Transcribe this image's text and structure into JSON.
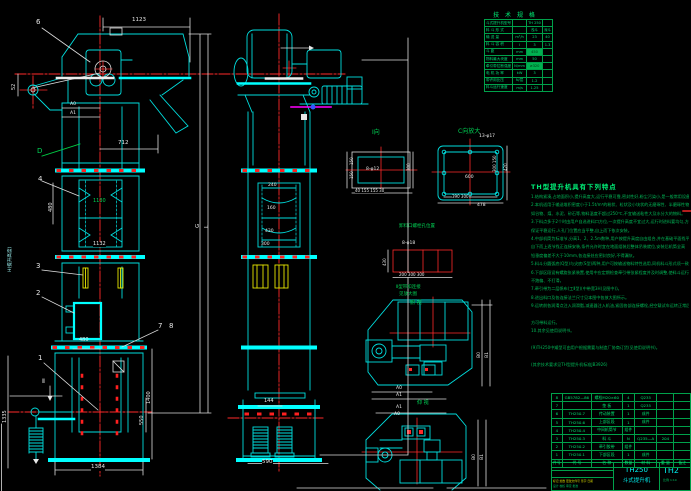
{
  "drawing": {
    "labels": {
      "b6": "6",
      "dim1123": "1123",
      "dim52": "52",
      "a0": "A0",
      "a1": "A1",
      "dlabel": "D",
      "dim712": "712",
      "b4": "4",
      "dim480a": "480",
      "dim1130": "1130",
      "dim1132": "1132",
      "htext": "H(提升高度)",
      "b3": "3",
      "b2": "2",
      "gG": "G",
      "gL": "L",
      "b1": "1",
      "sii": "Ⅱ",
      "dim480b": "480",
      "dim1400": "1400",
      "dim550": "550",
      "dim1335": "1335",
      "dim1384": "1384",
      "b7": "7",
      "b8": "8",
      "s240": "240",
      "s160": "160",
      "s430": "430",
      "s300": "300",
      "dim144": "144",
      "dim590": "590",
      "v1title": "Ⅰ向",
      "v1l1": "150",
      "v1l2": "150",
      "v1r": "300",
      "v1holes": "8-φ12",
      "v1bot": "40 155 155 30",
      "v2title": "C向放大",
      "v2holes": "13-φ17",
      "v2_600": "600",
      "v2r1": "300 150",
      "v2r2": "420",
      "v2bot": "390  300",
      "v2total": "478",
      "rgtitle": "卸料口螺栓孔位置",
      "rgholes": "8-φ18",
      "rg430": "430",
      "rgdims": "200  300  300",
      "bn1": "Ⅱ型带扣连接",
      "bn2": "见放大图",
      "pv1title": "俯 视",
      "pv2title": "仰 视",
      "pv1a0": "A0",
      "pv1a1": "A1",
      "pv1b0": "B0",
      "pv1b1": "B1",
      "pv2a1": "A1",
      "pv2a0": "A0",
      "pv2b0": "B0",
      "pv2b1": "B1"
    },
    "spec_table": {
      "title": "技 术 规 格",
      "rows": [
        [
          "斗式提升机型号",
          "",
          "TH 250",
          ""
        ],
        [
          "料 斗 形 式",
          "",
          "浅斗",
          "深斗"
        ],
        [
          "输 送 量",
          "m³/h",
          "23",
          "40"
        ],
        [
          "料 斗 容 积",
          "l",
          "3",
          "1.3"
        ],
        [
          "斗  距",
          "mm",
          "450",
          ""
        ],
        [
          "物料最大块度",
          "mm",
          "50",
          ""
        ],
        [
          "牵引带拉断强度",
          "N/mm",
          "≥320",
          ""
        ],
        [
          "电 机 功 率",
          "kW",
          "3",
          ""
        ],
        [
          "带许用比压",
          "N/层",
          "1.2",
          ""
        ],
        [
          "料斗运行速度",
          "m/s",
          "1.25",
          ""
        ]
      ]
    },
    "notes": {
      "title": "TH型提升机具有下列特点",
      "lines": [
        "1.结构紧凑,占地面积小,提升高度大,运行平稳可靠,密封性好,粉尘污染小,是一般常用设备。",
        "2.本机适用于输送堆积密度小于1.5t/m³的粉状、粒状及小块状的无磨琢性、半磨琢性物料,",
        "  如谷物、煤、水泥、砂石等,物料温度不超过250℃,不宜输送粘性大及水分大的物料。",
        "3.下料点多于2个时由用户自选进料口方位,一次提升高度不宜过大,运行时进料要均匀,方可",
        "  保证平稳运行,人孔门位置应当平整,自上而下依次安装。",
        "4.中部机筒为标准节,分高1、2、2.5m数种,用户按提升高度自由组合,并在基础平面找平后,",
        "  自下而上逐节找正连接安装,条件允许时宜在地面组装后整体吊装就位,安装后机筒全高",
        "  铅垂度偏差不大于10mm,各连接处应密封良好,不得漏灰。",
        "5.料斗分圆弧底(Q型)与尖底(S型)两种,用户可按输送物料特性选用,同机料斗形式须一致。",
        "6.下部区段设有螺旋张紧装置,使用中应定期检查牵引带张紧程度并及时调整,使料斗运行",
        "  不跑偏、不打滑。",
        "7.牵引带为二层帆布(工Ⅱ型)(中带宽3H(见图中))。",
        "8.进出料口及各连接法兰尺寸见本图中各放大图所示。",
        "9.运转前各润滑点注入润滑脂,减速器注入机油,紧固各部连接螺栓,经空载试车运转正常后",
        "",
        "  方可带料运行。",
        "10.其余见使用说明书。",
        "",
        "(9)TH250中矮型可由用户根据需要与制造厂协商订货(见使用说明书)。",
        "",
        "(其余技术要求见TH型提升机标准JB3926)"
      ]
    },
    "bom": {
      "header": [
        "件号",
        "代 号",
        "名 称",
        "数量",
        "材 料",
        "重 量",
        "备注"
      ],
      "rows": [
        [
          "8",
          "GB5782—86",
          "螺栓M20×60",
          "4",
          "Q235",
          "",
          ""
        ],
        [
          "7",
          "",
          "垫 板",
          "1",
          "Q235",
          "",
          ""
        ],
        [
          "6",
          "TH250.7",
          "传动装置",
          "1",
          "成件",
          "",
          ""
        ],
        [
          "5",
          "TH250.6",
          "上部区段",
          "1",
          "成件",
          "",
          ""
        ],
        [
          "4",
          "TH250.4",
          "中间机筒节",
          "组件",
          "",
          "",
          ""
        ],
        [
          "3",
          "TH250.3",
          "料 斗",
          "N",
          "Q235—A",
          "204",
          ""
        ],
        [
          "2",
          "TH250.2",
          "牵引胶带",
          "组件",
          "",
          "",
          ""
        ],
        [
          "1",
          "TH250.1",
          "下部区段",
          "1",
          "成件",
          "",
          ""
        ]
      ]
    },
    "title_block": {
      "model": "TH250",
      "name": "斗式提升机",
      "dwg_no": "TH2",
      "rev_row": "标记 处数 更改文件号 签字 日期",
      "sig_row": "设计 校核 审定 批准",
      "scale": "比例 1:10"
    }
  }
}
